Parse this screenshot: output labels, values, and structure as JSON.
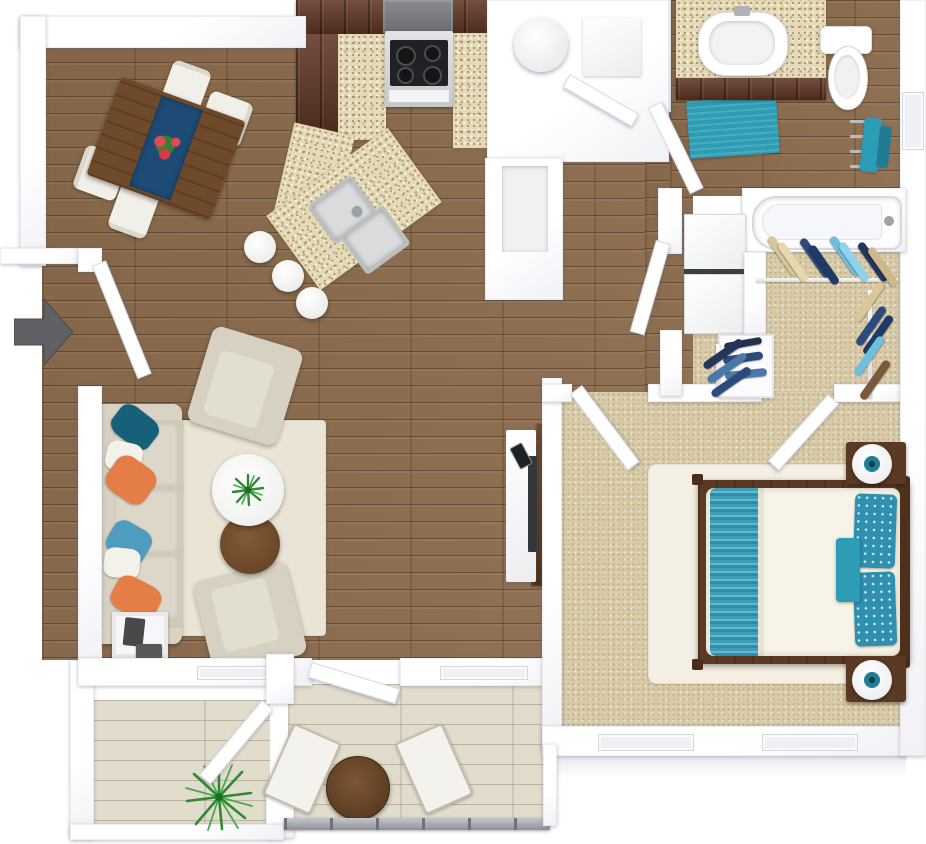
{
  "title": "3D apartment floor plan — one bedroom, one bath with balcony",
  "entry": {
    "indicator": "entry-arrow",
    "direction": "right"
  },
  "palette": {
    "wall": "#ffffff",
    "hardwood": "#8b6b4c",
    "balcony_wood": "#e2dccd",
    "carpet": "#d9cba8",
    "granite": "#e5d9b6",
    "cabinet_wood": "#5b3220",
    "teal": "#2d9db5",
    "teal_dark": "#17607a",
    "teal_deep": "#1f7c92",
    "orange": "#e47d46",
    "light_blue": "#4f9cbe",
    "navy": "#2c4a7c",
    "sofa_beige": "#cfc9b8",
    "cushion_beige": "#dcd7c8",
    "rug_cream": "#eae4d6",
    "bed_frame": "#5a3a24",
    "duvet": "#f7f3e7",
    "stove_gray": "#77787c",
    "cooktop_black": "#202124",
    "stainless": "#bcbfc1",
    "arrow_gray": "#5f6164",
    "plant_green": "#2e8b33",
    "table_brown": "#6e4826",
    "railing_gray": "#9aa0a4"
  },
  "rooms": [
    {
      "id": "dining-area",
      "label": "Dining Area",
      "floor": "hardwood",
      "furniture": [
        {
          "item": "dining-table",
          "qty": 1
        },
        {
          "item": "blue-table-runner",
          "qty": 1
        },
        {
          "item": "flower-centerpiece",
          "qty": 1
        },
        {
          "item": "dining-chair",
          "qty": 4
        }
      ]
    },
    {
      "id": "kitchen",
      "label": "Kitchen",
      "floor": "hardwood",
      "furniture": [
        {
          "item": "dark-wood-cabinets",
          "qty": 1
        },
        {
          "item": "range-hood",
          "qty": 1
        },
        {
          "item": "stove-oven",
          "qty": 1
        },
        {
          "item": "granite-counter",
          "qty": 1
        },
        {
          "item": "granite-island",
          "qty": 1
        },
        {
          "item": "double-basin-sink",
          "qty": 1
        },
        {
          "item": "bar-stool",
          "qty": 3
        }
      ]
    },
    {
      "id": "living-room",
      "label": "Living Room",
      "floor": "hardwood",
      "furniture": [
        {
          "item": "sofa",
          "qty": 1
        },
        {
          "item": "throw-pillow",
          "qty": 6
        },
        {
          "item": "area-rug",
          "qty": 1
        },
        {
          "item": "armchair",
          "qty": 2
        },
        {
          "item": "round-coffee-table",
          "qty": 1
        },
        {
          "item": "round-side-table",
          "qty": 1
        },
        {
          "item": "potted-plant",
          "qty": 1
        },
        {
          "item": "end-table",
          "qty": 1
        },
        {
          "item": "tv-console",
          "qty": 1
        },
        {
          "item": "tv",
          "qty": 1
        }
      ]
    },
    {
      "id": "hallway",
      "label": "Hallway / Utility",
      "floor": "hardwood",
      "furniture": [
        {
          "item": "water-heater",
          "qty": 1
        },
        {
          "item": "pantry-closet",
          "qty": 1
        }
      ]
    },
    {
      "id": "bathroom",
      "label": "Bathroom",
      "floor": "hardwood",
      "furniture": [
        {
          "item": "vanity-with-sink",
          "qty": 1
        },
        {
          "item": "toilet",
          "qty": 1
        },
        {
          "item": "bath-mat",
          "qty": 1
        },
        {
          "item": "towel-rack",
          "qty": 1
        },
        {
          "item": "bathtub",
          "qty": 1
        }
      ]
    },
    {
      "id": "laundry",
      "label": "Laundry Nook",
      "floor": "hardwood",
      "furniture": [
        {
          "item": "stacked-washer-dryer",
          "qty": 1
        },
        {
          "item": "linen-shelves",
          "qty": 1
        }
      ]
    },
    {
      "id": "walk-in-closet",
      "label": "Walk-in Closet",
      "floor": "carpet",
      "furniture": [
        {
          "item": "clothes-rod",
          "qty": 3
        },
        {
          "item": "hanging-clothes-group",
          "qty": 4
        }
      ]
    },
    {
      "id": "bedroom",
      "label": "Bedroom",
      "floor": "carpet",
      "furniture": [
        {
          "item": "bed",
          "qty": 1
        },
        {
          "item": "teal-striped-runner",
          "qty": 1
        },
        {
          "item": "floral-pillow",
          "qty": 2
        },
        {
          "item": "accent-pillow",
          "qty": 1
        },
        {
          "item": "area-rug",
          "qty": 1
        },
        {
          "item": "nightstand",
          "qty": 2
        },
        {
          "item": "table-lamp",
          "qty": 2
        },
        {
          "item": "window",
          "qty": 2
        }
      ]
    },
    {
      "id": "balcony",
      "label": "Balcony",
      "floor": "light-plank",
      "furniture": [
        {
          "item": "bistro-table",
          "qty": 1
        },
        {
          "item": "patio-chair",
          "qty": 2
        },
        {
          "item": "potted-palm",
          "qty": 1
        },
        {
          "item": "glass-railing",
          "qty": 1
        },
        {
          "item": "window",
          "qty": 2
        }
      ]
    },
    {
      "id": "balcony-storage",
      "label": "Balcony Storage",
      "floor": "light-plank",
      "furniture": []
    }
  ]
}
